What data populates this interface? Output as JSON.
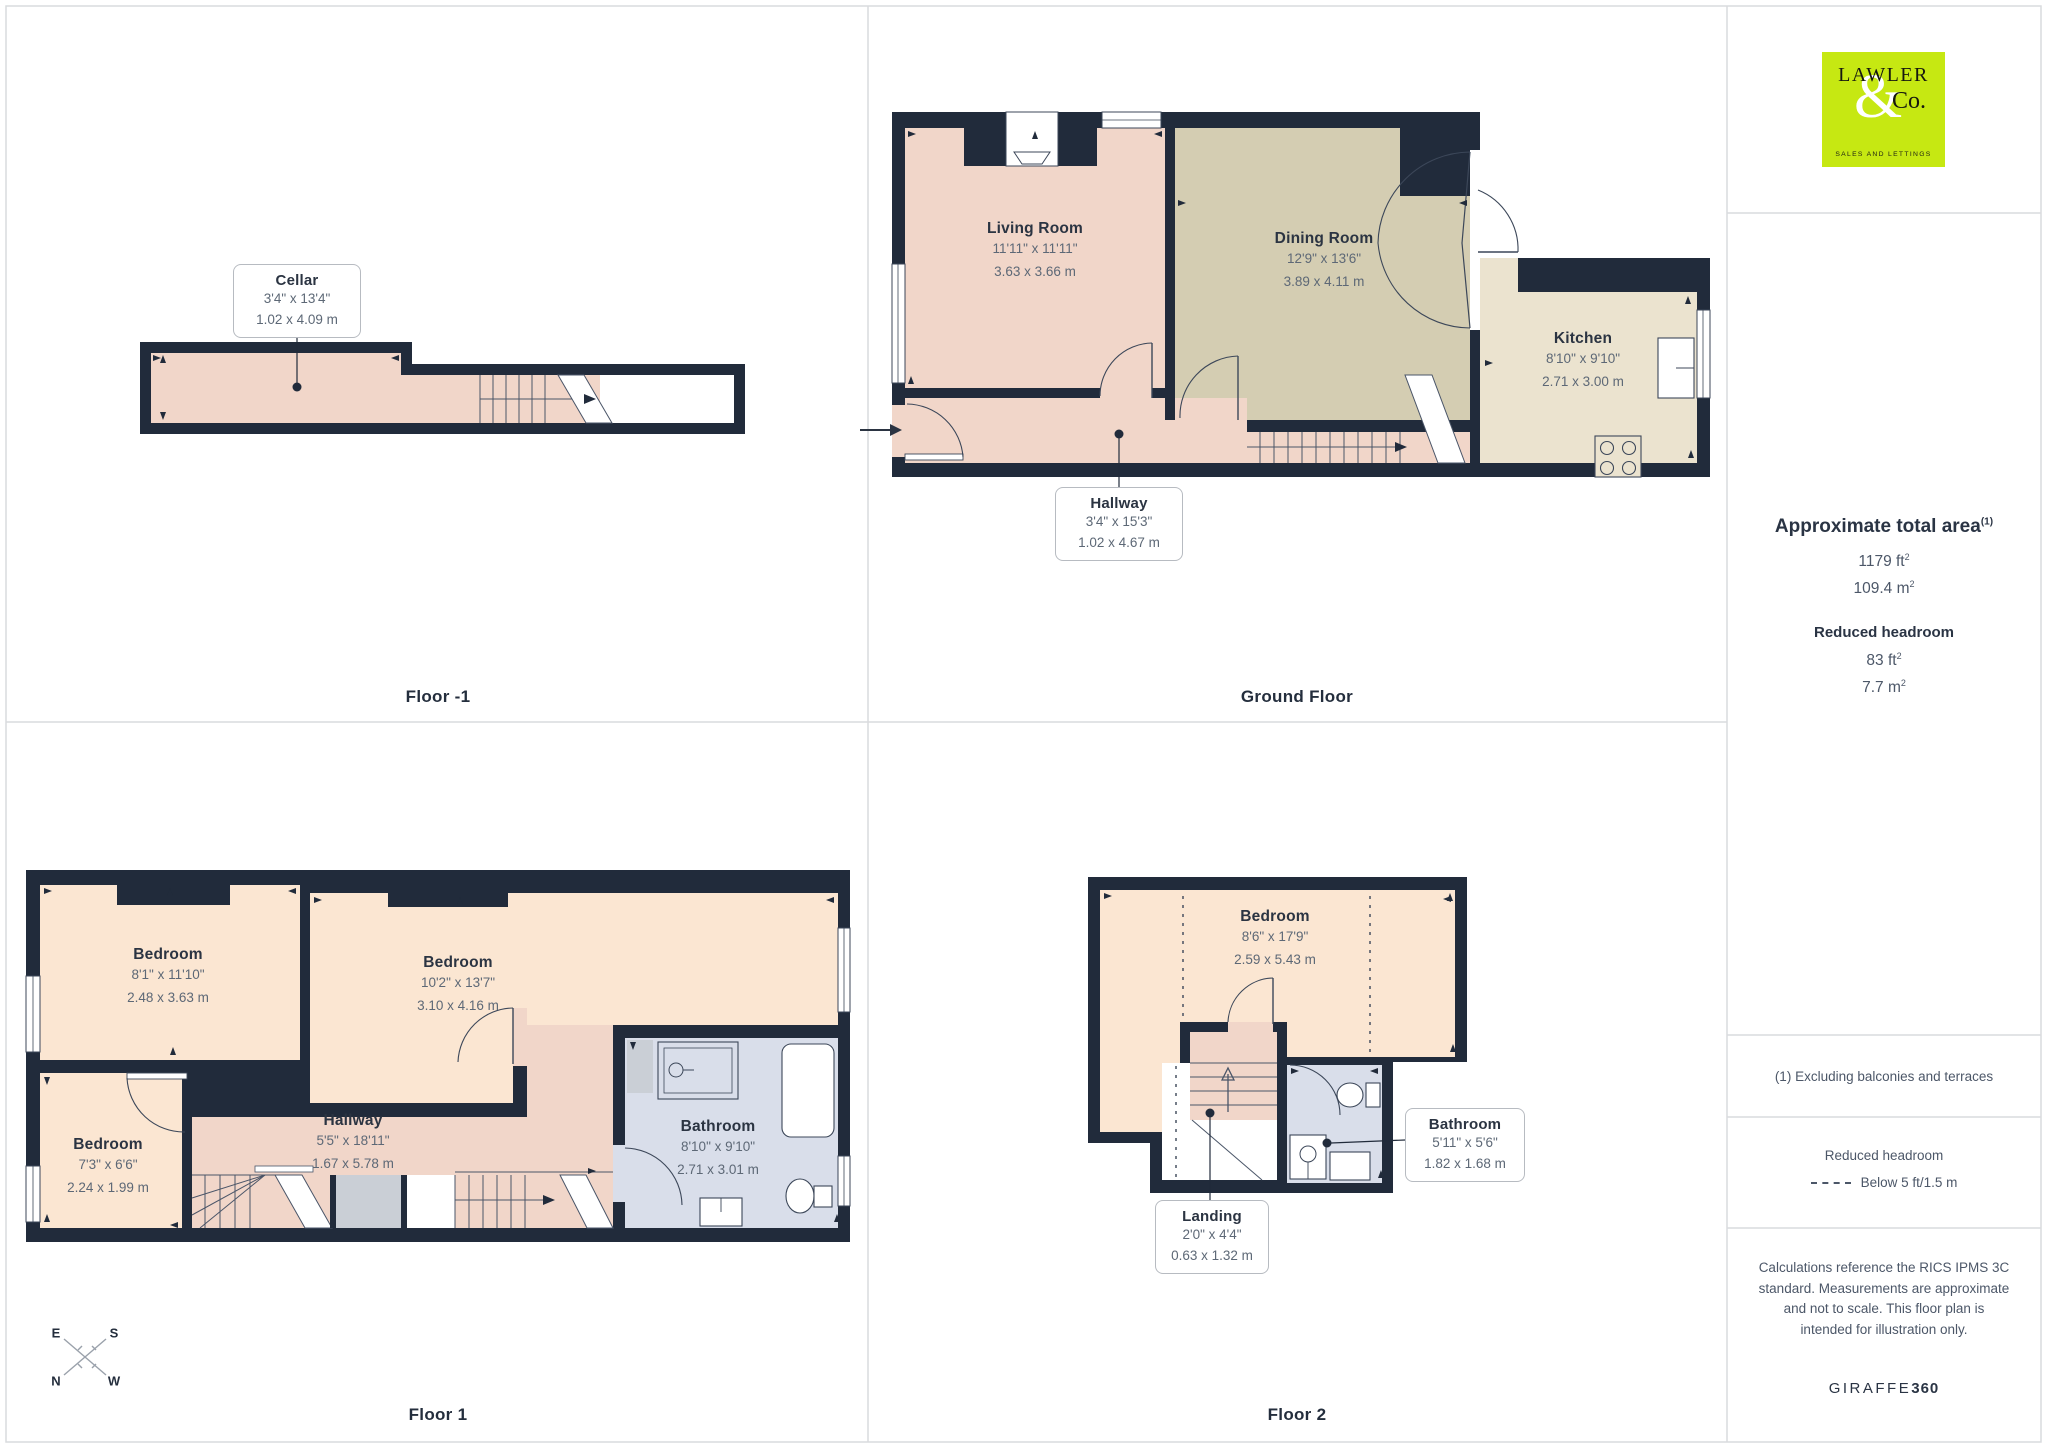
{
  "floors": [
    {
      "label": "Floor -1",
      "rooms": [
        {
          "name": "Cellar",
          "imperial": "3'4\" x 13'4\"",
          "metric": "1.02 x 4.09 m"
        }
      ]
    },
    {
      "label": "Ground Floor",
      "rooms": [
        {
          "name": "Living Room",
          "imperial": "11'11\" x 11'11\"",
          "metric": "3.63 x 3.66 m"
        },
        {
          "name": "Dining Room",
          "imperial": "12'9\" x 13'6\"",
          "metric": "3.89 x 4.11 m"
        },
        {
          "name": "Kitchen",
          "imperial": "8'10\" x 9'10\"",
          "metric": "2.71 x 3.00 m"
        },
        {
          "name": "Hallway",
          "imperial": "3'4\" x 15'3\"",
          "metric": "1.02 x 4.67 m"
        }
      ]
    },
    {
      "label": "Floor 1",
      "rooms": [
        {
          "name": "Bedroom",
          "imperial": "8'1\" x 11'10\"",
          "metric": "2.48 x 3.63 m"
        },
        {
          "name": "Bedroom",
          "imperial": "10'2\" x 13'7\"",
          "metric": "3.10 x 4.16 m"
        },
        {
          "name": "Bedroom",
          "imperial": "7'3\" x 6'6\"",
          "metric": "2.24 x 1.99 m"
        },
        {
          "name": "Hallway",
          "imperial": "5'5\" x 18'11\"",
          "metric": "1.67 x 5.78 m"
        },
        {
          "name": "Bathroom",
          "imperial": "8'10\" x 9'10\"",
          "metric": "2.71 x 3.01 m"
        }
      ]
    },
    {
      "label": "Floor 2",
      "rooms": [
        {
          "name": "Bedroom",
          "imperial": "8'6\" x 17'9\"",
          "metric": "2.59 x 5.43 m"
        },
        {
          "name": "Bathroom",
          "imperial": "5'11\" x 5'6\"",
          "metric": "1.82 x 1.68 m"
        },
        {
          "name": "Landing",
          "imperial": "2'0\" x 4'4\"",
          "metric": "0.63 x 1.32 m"
        }
      ]
    }
  ],
  "sidebar": {
    "logo": {
      "name": "LAWLER",
      "amp": "&",
      "co": "Co.",
      "tagline": "SALES AND LETTINGS"
    },
    "area": {
      "heading": "Approximate total area",
      "sup": "(1)",
      "imperial_value": "1179 ft",
      "imperial_sup": "2",
      "metric_value": "109.4 m",
      "metric_sup": "2"
    },
    "reduced": {
      "heading": "Reduced headroom",
      "imperial_value": "83 ft",
      "imperial_sup": "2",
      "metric_value": "7.7 m",
      "metric_sup": "2"
    },
    "note": "(1) Excluding balconies and terraces",
    "legend": {
      "heading": "Reduced headroom",
      "label": "Below 5 ft/1.5 m"
    },
    "disclaimer": "Calculations reference the RICS IPMS 3C standard. Measurements are approximate and not to scale. This floor plan is intended for illustration only.",
    "brand": {
      "name": "GIRAFFE",
      "number": "360"
    }
  },
  "compass": {
    "e": "E",
    "s": "S",
    "n": "N",
    "w": "W"
  },
  "colors": {
    "wall": "#212b3b",
    "pink": "#f1d6c9",
    "cream": "#fbe6d2",
    "tan": "#d4cdb2",
    "kitchen": "#ebe3cf",
    "bath": "#d9deea",
    "logo_green": "#c6e812"
  }
}
